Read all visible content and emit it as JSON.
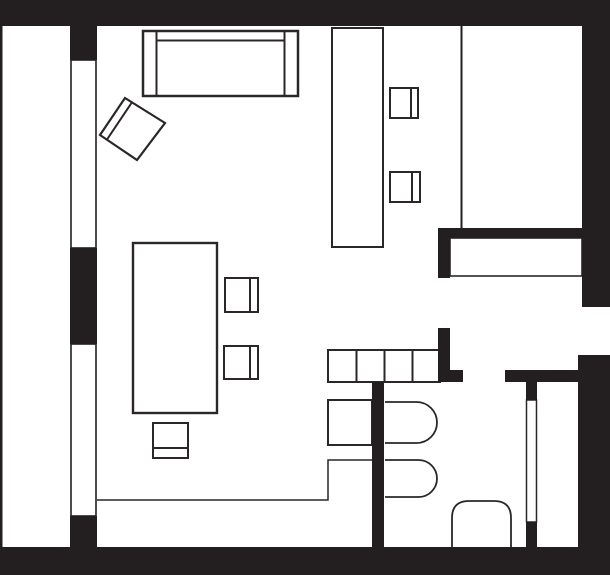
{
  "document": {
    "kind": "apartment-floor-plan",
    "description": "Black-and-white architectural floor plan of a studio apartment with living area, bedroom, kitchen zone and bathroom/closet block. No text labels visible."
  },
  "canvas": {
    "width": 610,
    "height": 575,
    "background": "#ffffff"
  },
  "colors": {
    "wall": "#231f20",
    "stroke": "#2b2728",
    "white": "#ffffff",
    "none": "none"
  },
  "elements": [
    {
      "name": "left-window-upper",
      "type": "rect",
      "x": 71,
      "y": 60,
      "w": 25,
      "h": 188,
      "fill": "white",
      "stroke": "wall",
      "sw": 1.6
    },
    {
      "name": "left-window-lower",
      "type": "rect",
      "x": 71,
      "y": 344,
      "w": 25,
      "h": 172,
      "fill": "white",
      "stroke": "wall",
      "sw": 1.6
    },
    {
      "name": "hallway-sideboard",
      "type": "rect",
      "x": 450,
      "y": 238,
      "w": 132,
      "h": 38,
      "fill": "white",
      "stroke": "stroke",
      "sw": 1.6
    },
    {
      "name": "closet-door-leaf",
      "type": "rect",
      "x": 526.5,
      "y": 400,
      "w": 10,
      "h": 122,
      "fill": "white",
      "stroke": "stroke",
      "sw": 1.5
    },
    {
      "name": "sofa",
      "type": "rect",
      "x": 143,
      "y": 31,
      "w": 155,
      "h": 65,
      "fill": "white",
      "stroke": "stroke",
      "sw": 2.5
    },
    {
      "name": "sofa-left-armrest-line",
      "type": "line",
      "x1": 156.5,
      "y1": 31,
      "x2": 156.5,
      "y2": 96,
      "stroke": "stroke",
      "sw": 2
    },
    {
      "name": "sofa-right-armrest-line",
      "type": "line",
      "x1": 284.5,
      "y1": 31,
      "x2": 284.5,
      "y2": 96,
      "stroke": "stroke",
      "sw": 2
    },
    {
      "name": "sofa-backrest-line",
      "type": "line",
      "x1": 156,
      "y1": 40.5,
      "x2": 285,
      "y2": 40.5,
      "stroke": "stroke",
      "sw": 2
    },
    {
      "name": "armchair",
      "type": "polygon",
      "points": "125,98 165,123 137,160 100,135",
      "fill": "white",
      "stroke": "stroke",
      "sw": 2.2
    },
    {
      "name": "armchair-backrest-line",
      "type": "line",
      "x1": 107,
      "y1": 139.5,
      "x2": 131.5,
      "y2": 103,
      "stroke": "stroke",
      "sw": 2
    },
    {
      "name": "desk",
      "type": "rect",
      "x": 332,
      "y": 28,
      "w": 51,
      "h": 219,
      "fill": "white",
      "stroke": "stroke",
      "sw": 2
    },
    {
      "name": "desk-chair-1-seat",
      "type": "rect",
      "x": 390,
      "y": 88,
      "w": 28,
      "h": 30,
      "fill": "white",
      "stroke": "stroke",
      "sw": 2
    },
    {
      "name": "desk-chair-1-backrest",
      "type": "line",
      "x1": 411,
      "y1": 88,
      "x2": 411,
      "y2": 118,
      "stroke": "stroke",
      "sw": 2
    },
    {
      "name": "desk-chair-2-seat",
      "type": "rect",
      "x": 390,
      "y": 172,
      "w": 30,
      "h": 30,
      "fill": "white",
      "stroke": "stroke",
      "sw": 2
    },
    {
      "name": "desk-chair-2-backrest",
      "type": "line",
      "x1": 412,
      "y1": 172,
      "x2": 412,
      "y2": 202,
      "stroke": "stroke",
      "sw": 2
    },
    {
      "name": "dining-table",
      "type": "rect",
      "x": 133,
      "y": 243,
      "w": 84,
      "h": 170,
      "fill": "white",
      "stroke": "stroke",
      "sw": 2.4
    },
    {
      "name": "dining-chair-1-seat",
      "type": "rect",
      "x": 225,
      "y": 278,
      "w": 33,
      "h": 34,
      "fill": "white",
      "stroke": "stroke",
      "sw": 2
    },
    {
      "name": "dining-chair-1-backrest",
      "type": "line",
      "x1": 250,
      "y1": 278,
      "x2": 250,
      "y2": 312,
      "stroke": "stroke",
      "sw": 2
    },
    {
      "name": "dining-chair-2-seat",
      "type": "rect",
      "x": 224,
      "y": 346,
      "w": 34,
      "h": 33,
      "fill": "white",
      "stroke": "stroke",
      "sw": 2
    },
    {
      "name": "dining-chair-2-backrest",
      "type": "line",
      "x1": 250,
      "y1": 346,
      "x2": 250,
      "y2": 379,
      "stroke": "stroke",
      "sw": 2
    },
    {
      "name": "dining-chair-3-seat",
      "type": "rect",
      "x": 153,
      "y": 423,
      "w": 35,
      "h": 35,
      "fill": "white",
      "stroke": "stroke",
      "sw": 2
    },
    {
      "name": "dining-chair-3-backrest",
      "type": "line",
      "x1": 153,
      "y1": 448,
      "x2": 188,
      "y2": 448,
      "stroke": "stroke",
      "sw": 2
    },
    {
      "name": "kitchen-counter",
      "type": "rect",
      "x": 328,
      "y": 350,
      "w": 112,
      "h": 32,
      "fill": "white",
      "stroke": "stroke",
      "sw": 2
    },
    {
      "name": "kitchen-counter-divider-1",
      "type": "line",
      "x1": 356.5,
      "y1": 350,
      "x2": 356.5,
      "y2": 382,
      "stroke": "stroke",
      "sw": 2
    },
    {
      "name": "kitchen-counter-divider-2",
      "type": "line",
      "x1": 384.5,
      "y1": 350,
      "x2": 384.5,
      "y2": 382,
      "stroke": "stroke",
      "sw": 2
    },
    {
      "name": "kitchen-counter-divider-3",
      "type": "line",
      "x1": 412.5,
      "y1": 350,
      "x2": 412.5,
      "y2": 382,
      "stroke": "stroke",
      "sw": 2
    },
    {
      "name": "kitchen-appliance",
      "type": "rect",
      "x": 328,
      "y": 400,
      "w": 44,
      "h": 45,
      "fill": "white",
      "stroke": "stroke",
      "sw": 2
    },
    {
      "name": "kitchen-zone-line",
      "type": "polyline",
      "points": "97,500 328,500 328,460 372,460",
      "fill": "none",
      "stroke": "stroke",
      "sw": 1.5
    },
    {
      "name": "bathroom-basin-1",
      "type": "path",
      "d": "M 385 402 L 416.5 402 A 20.5 20.5 0 0 1 437 422.5 A 20.5 20.5 0 0 1 416.5 443 L 385 443",
      "fill": "white",
      "stroke": "stroke",
      "sw": 1.8
    },
    {
      "name": "bathroom-basin-2",
      "type": "path",
      "d": "M 385 460 L 418.5 460 A 18.5 18.5 0 0 1 437 478.5 A 18.5 18.5 0 0 1 418.5 497 L 385 497",
      "fill": "white",
      "stroke": "stroke",
      "sw": 1.8
    },
    {
      "name": "toilet",
      "type": "path",
      "d": "M 452 547 L 452 518 Q 452 501 469 501 L 494 501 Q 511 501 511 518 L 511 547",
      "fill": "white",
      "stroke": "stroke",
      "sw": 1.8
    },
    {
      "name": "bedroom-partition-line",
      "type": "line",
      "x1": 461.5,
      "y1": 26,
      "x2": 461.5,
      "y2": 228,
      "stroke": "wall",
      "sw": 2
    },
    {
      "name": "top-wall",
      "type": "rect",
      "x": 0,
      "y": 0,
      "w": 610,
      "h": 26,
      "fill": "wall"
    },
    {
      "name": "bottom-wall",
      "type": "rect",
      "x": 0,
      "y": 547,
      "w": 610,
      "h": 28,
      "fill": "wall"
    },
    {
      "name": "balcony-edge-line",
      "type": "rect",
      "x": 0,
      "y": 26,
      "w": 2.5,
      "h": 521,
      "fill": "wall"
    },
    {
      "name": "left-wall-upper",
      "type": "rect",
      "x": 70,
      "y": 26,
      "w": 27,
      "h": 34,
      "fill": "wall"
    },
    {
      "name": "left-wall-middle",
      "type": "rect",
      "x": 70,
      "y": 248,
      "w": 27,
      "h": 96,
      "fill": "wall"
    },
    {
      "name": "left-wall-lower",
      "type": "rect",
      "x": 70,
      "y": 516,
      "w": 27,
      "h": 32,
      "fill": "wall"
    },
    {
      "name": "right-wall-upper",
      "type": "rect",
      "x": 582,
      "y": 0,
      "w": 28,
      "h": 307,
      "fill": "wall"
    },
    {
      "name": "right-wall-lower",
      "type": "rect",
      "x": 578,
      "y": 355,
      "w": 32,
      "h": 220,
      "fill": "wall"
    },
    {
      "name": "bedroom-south-wall",
      "type": "rect",
      "x": 438,
      "y": 228,
      "w": 144,
      "h": 10,
      "fill": "wall"
    },
    {
      "name": "bedroom-wall-stub",
      "type": "rect",
      "x": 438,
      "y": 228,
      "w": 12,
      "h": 50,
      "fill": "wall"
    },
    {
      "name": "bathroom-wall-upper",
      "type": "rect",
      "x": 438,
      "y": 328,
      "w": 12,
      "h": 54,
      "fill": "wall"
    },
    {
      "name": "bathroom-wall-foot",
      "type": "rect",
      "x": 438,
      "y": 370,
      "w": 25,
      "h": 12,
      "fill": "wall"
    },
    {
      "name": "bathroom-door-header",
      "type": "rect",
      "x": 505,
      "y": 370,
      "w": 73,
      "h": 12,
      "fill": "wall"
    },
    {
      "name": "bathroom-partition-wall",
      "type": "rect",
      "x": 372,
      "y": 382,
      "w": 12,
      "h": 165,
      "fill": "wall"
    },
    {
      "name": "closet-door-jamb-top",
      "type": "rect",
      "x": 526,
      "y": 381,
      "w": 11,
      "h": 19,
      "fill": "wall"
    },
    {
      "name": "closet-door-jamb-bottom",
      "type": "rect",
      "x": 526,
      "y": 522,
      "w": 11,
      "h": 25,
      "fill": "wall"
    }
  ]
}
